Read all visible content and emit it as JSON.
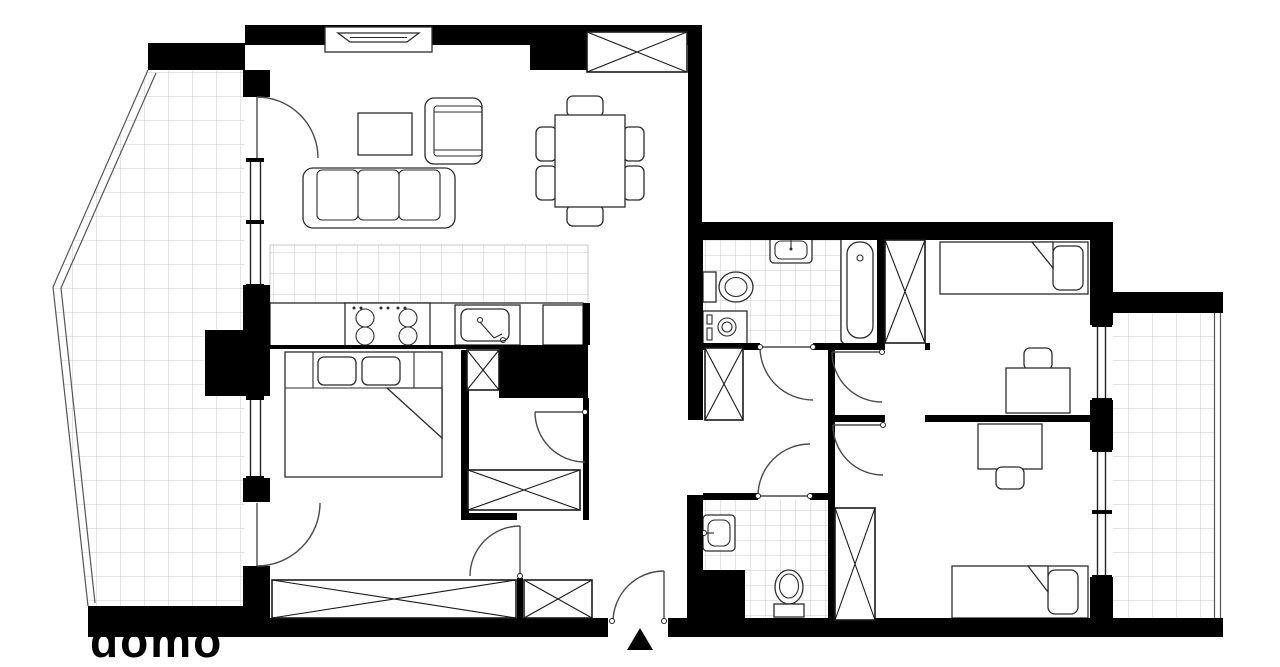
{
  "watermark": {
    "text": "domo"
  },
  "colors": {
    "wall": "#000000",
    "floor": "#ffffff",
    "tile_grid": "#c9c9c9",
    "furniture_stroke": "#2b2b2b",
    "door_arc": "#4a4a4a"
  },
  "plan": {
    "type": "apartment-floor-plan",
    "entrance_marker": "black triangle at bottom center",
    "rooms": [
      {
        "name": "living-dining-room",
        "furniture": [
          "tv-cabinet",
          "armchair",
          "coffee-table",
          "three-seat-sofa",
          "dining-table",
          "six-dining-chairs",
          "built-in-wardrobe"
        ]
      },
      {
        "name": "kitchen",
        "furniture": [
          "tiled-floor",
          "countertop",
          "four-burner-cooktop",
          "kitchen-sink",
          "fridge"
        ]
      },
      {
        "name": "bedroom-1",
        "furniture": [
          "double-bed",
          "two-pillows",
          "wide-wardrobe",
          "small-closet"
        ]
      },
      {
        "name": "bathroom-1",
        "furniture": [
          "washbasin",
          "toilet",
          "washing-machine",
          "bathtub"
        ],
        "floor": "tiles"
      },
      {
        "name": "bedroom-2",
        "furniture": [
          "single-bed",
          "desk",
          "chair",
          "wardrobe"
        ]
      },
      {
        "name": "bedroom-3",
        "furniture": [
          "single-bed",
          "desk",
          "chair",
          "wardrobe"
        ]
      },
      {
        "name": "bathroom-2",
        "furniture": [
          "washbasin",
          "toilet"
        ],
        "floor": "tiles"
      },
      {
        "name": "hallway",
        "furniture": [
          "corridor-wardrobe",
          "entry-closet",
          "service-shafts"
        ]
      },
      {
        "name": "balcony-left",
        "floor": "tiles",
        "shape": "trapezoid"
      },
      {
        "name": "balcony-right",
        "floor": "tiles",
        "shape": "rectangle"
      }
    ]
  }
}
